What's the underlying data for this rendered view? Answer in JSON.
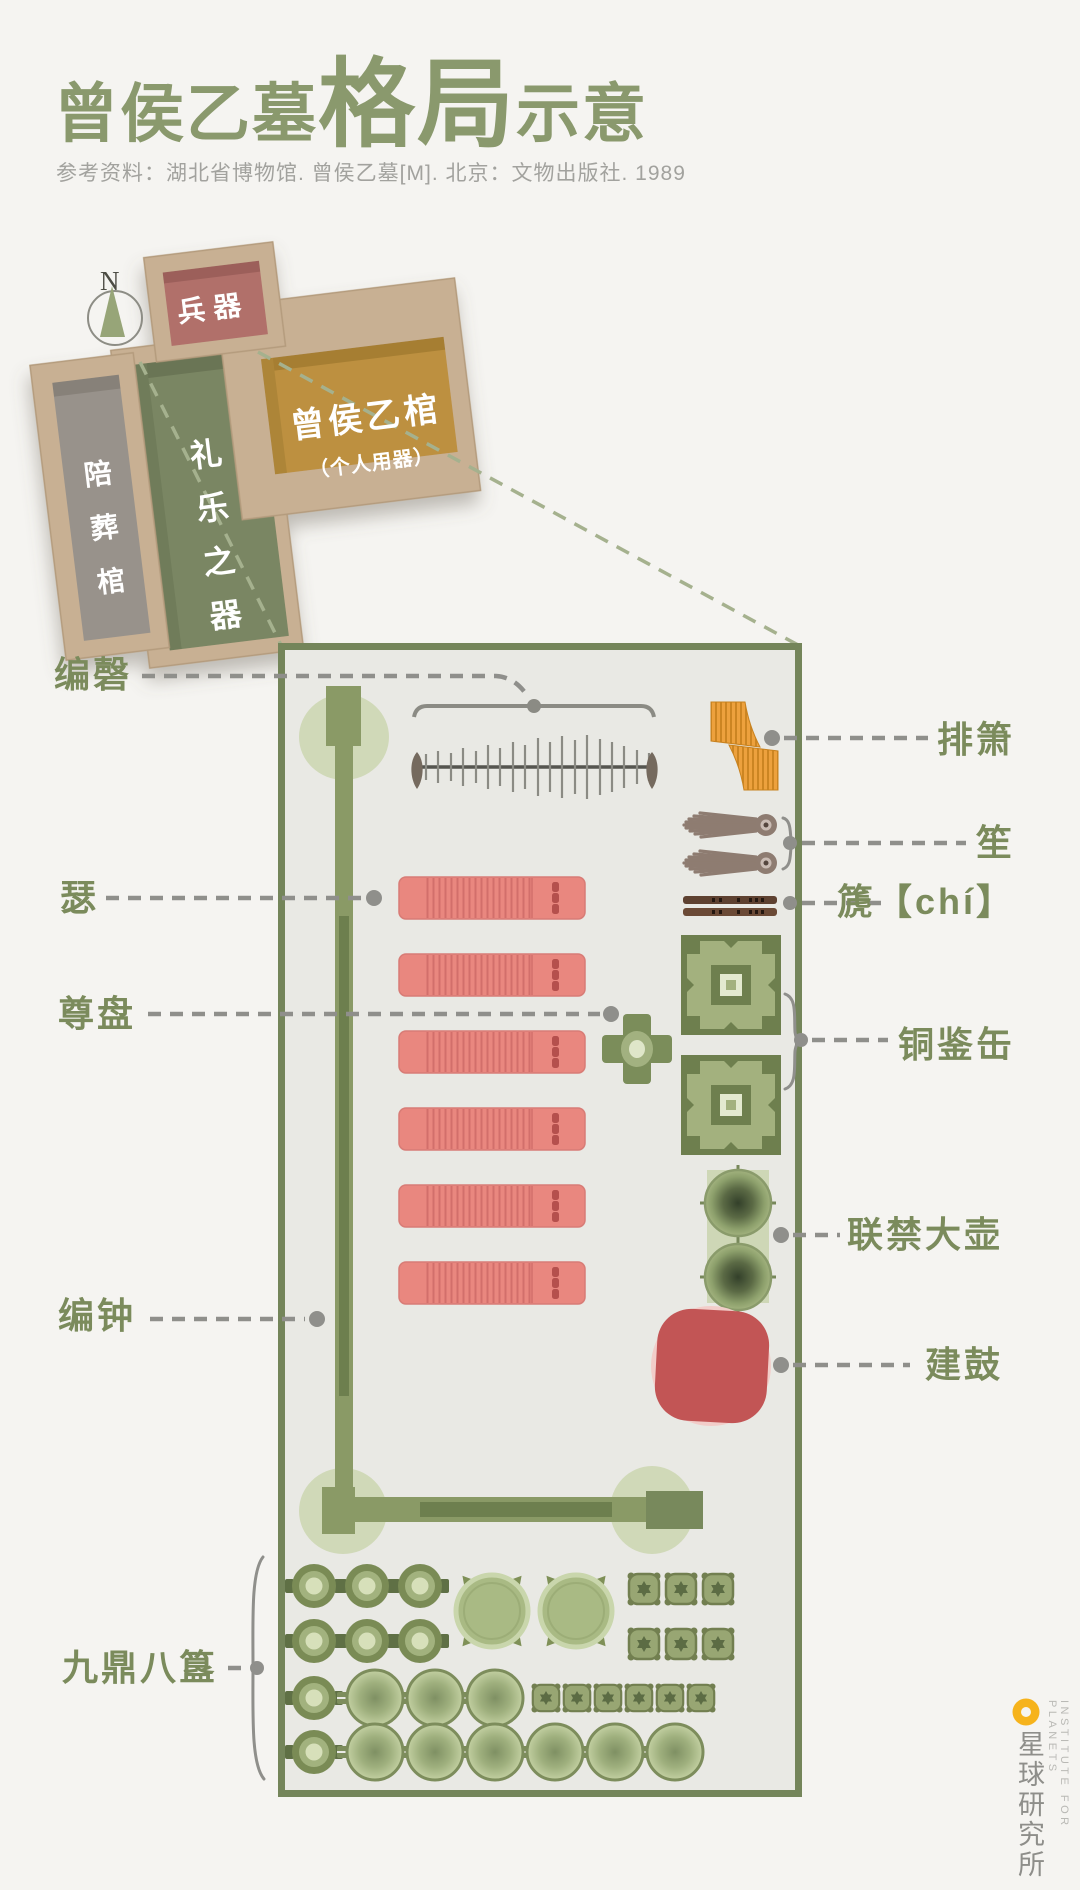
{
  "title": {
    "prefix": "曾侯乙墓",
    "emphasis": "格局",
    "suffix": "示意"
  },
  "reference": "参考资料：湖北省博物馆. 曾侯乙墓[M]. 北京：文物出版社. 1989",
  "compass": {
    "north": "N"
  },
  "tomb": {
    "chambers": {
      "weapons": "兵器",
      "coffins": "陪葬棺",
      "ritual": "礼乐之器",
      "marquis": "曾侯乙棺",
      "marquis_sub": "（个人用器）"
    }
  },
  "labels": {
    "bianqing": "编磬",
    "paixiao": "排箫",
    "sheng": "笙",
    "chi": "篪【chí】",
    "se": "瑟",
    "zunpan": "尊盘",
    "tongjianfou": "铜鉴缶",
    "lianjindahu": "联禁大壶",
    "bianzhong": "编钟",
    "jiangu": "建鼓",
    "jiudingbagui": "九鼎八簋"
  },
  "logo": {
    "name": "星球研究所",
    "tagline": "INSTITUTE FOR PLANETS"
  },
  "colors": {
    "background": "#f5f4f1",
    "title_green": "#8a996d",
    "label_green": "#7b8b5c",
    "plan_border": "#74855a",
    "plan_fill": "#e9e9e4",
    "rack_green": "#8a9a66",
    "zither_pink": "#e9877f",
    "drum_red": "#c25555",
    "panpipe_orange": "#eda13d",
    "cork": "#c8b093",
    "chamber_weapons_fill": "#b1706a",
    "chamber_coffins_fill": "#98928b",
    "chamber_ritual_fill": "#7a8663",
    "chamber_marquis_fill": "#bd9041",
    "logo_yellow": "#f6b31c",
    "dash_gray": "#8f8f8b"
  }
}
